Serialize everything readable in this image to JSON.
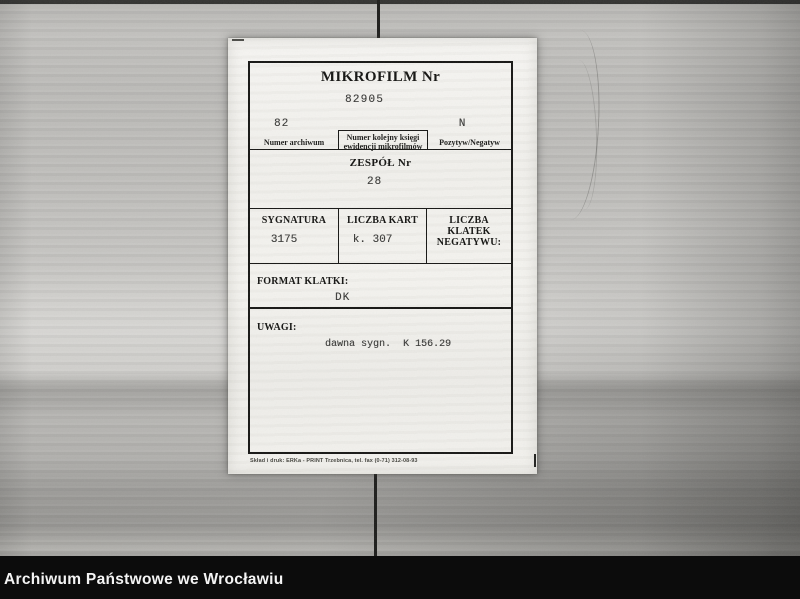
{
  "page": {
    "footer_caption": "Archiwum Państwowe we Wrocławiu"
  },
  "card": {
    "title": "MIKROFILM Nr",
    "microfilm_number": "82905",
    "archive_row": {
      "archive_number_value": "82",
      "archive_number_label": "Numer archiwum",
      "register_label_line1": "Numer kolejny księgi",
      "register_label_line2": "ewidencji mikrofilmów",
      "positive_negative_value": "N",
      "positive_negative_label": "Pozytyw/Negatyw"
    },
    "zespol": {
      "label": "ZESPÓŁ Nr",
      "value": "28"
    },
    "details_row": {
      "sygnatura_label": "SYGNATURA",
      "sygnatura_value": "3175",
      "liczba_kart_label": "LICZBA KART",
      "liczba_kart_value": "k. 307",
      "liczba_klatek_label_line1": "LICZBA KLATEK",
      "liczba_klatek_label_line2": "NEGATYWU:",
      "liczba_klatek_value": ""
    },
    "format_klatki": {
      "label": "FORMAT KLATKI:",
      "value": "DK"
    },
    "uwagi": {
      "label": "UWAGI:",
      "value": "dawna sygn.  K 156.29"
    },
    "printer_note": "Skład i druk: ERKa - PRINT Trzebnica, tel. fax (0-71) 312-08-93"
  },
  "colors": {
    "paper": "#f3f2ee",
    "background": "#b7b6b3",
    "caption_bar": "#0c0c0c",
    "caption_text": "#f4f4f4",
    "ink": "#161614",
    "typed_ink": "#3a3a38"
  }
}
